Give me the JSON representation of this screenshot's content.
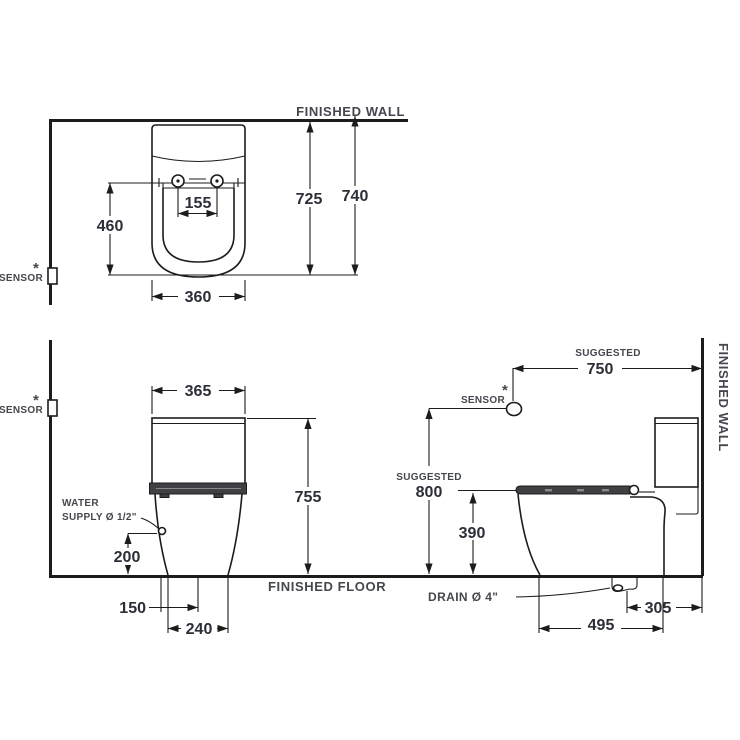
{
  "drawing": {
    "title": "toilet-installation-dimension-diagram",
    "labels": {
      "finished_wall": "FINISHED WALL",
      "finished_floor": "FINISHED FLOOR",
      "sensor": "SENSOR",
      "asterisk": "*",
      "suggested": "SUGGESTED",
      "water_line1": "WATER",
      "water_line2": "SUPPLY Ø 1/2\"",
      "drain": "DRAIN Ø 4\""
    },
    "dims": {
      "top": {
        "bolt_spacing": "155",
        "depth": "460",
        "wall_to_front": "725",
        "total_depth": "740",
        "width": "360"
      },
      "front": {
        "tank_width": "365",
        "height": "755",
        "supply_height": "200",
        "supply_offset": "150",
        "base_width": "240"
      },
      "side": {
        "sensor_distance": "750",
        "sensor_height": "800",
        "rim_height": "390",
        "drain_to_wall": "305",
        "depth": "495"
      }
    },
    "colors": {
      "line": "#1c1c1c",
      "dim_text": "#2c2e38",
      "label_text": "#45474e",
      "seat_fill": "#3f3f44",
      "background": "#ffffff"
    }
  }
}
